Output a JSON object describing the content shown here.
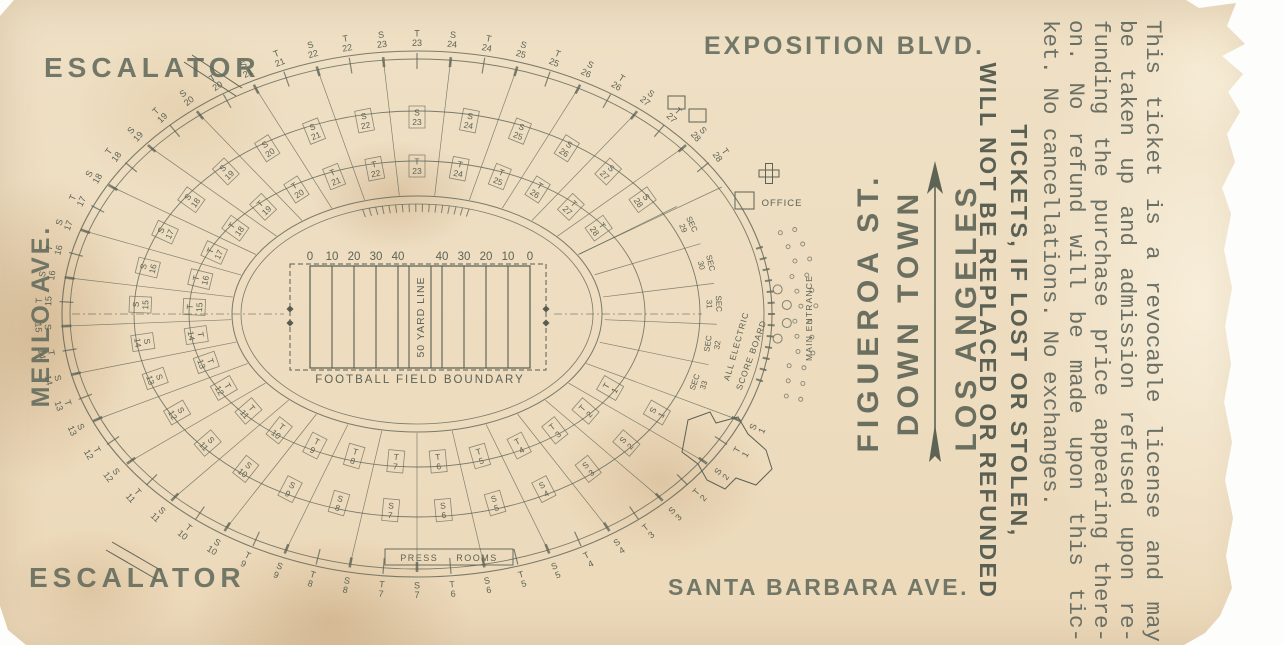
{
  "colors": {
    "ink": "#5c6255",
    "paper": "#efe0c5"
  },
  "streets": {
    "exposition": "EXPOSITION BLVD.",
    "santa_barbara": "SANTA BARBARA AVE.",
    "menlo": "MENLO AVE.",
    "escalator_top": "ESCALATOR",
    "escalator_bottom": "ESCALATOR"
  },
  "direction": {
    "street": "FIGUEROA ST.",
    "line2": "DOWN TOWN",
    "city": "LOS ANGELES"
  },
  "legal": {
    "lines": [
      "This ticket is a revocable license and may",
      "be taken up and admission refused upon re-",
      "funding the purchase price appearing there-",
      "on.  No refund will be made upon this tic-",
      "ket.  No cancellations.  No exchanges."
    ],
    "notice_line1": "TICKETS, IF LOST OR STOLEN,",
    "notice_line2": "WILL NOT BE REPLACED OR REFUNDED"
  },
  "field": {
    "yard_numbers": [
      "0",
      "10",
      "20",
      "30",
      "40",
      "40",
      "30",
      "20",
      "10",
      "0"
    ],
    "fifty_label": "50 YARD LINE",
    "boundary_label": "FOOTBALL FIELD BOUNDARY"
  },
  "stadium": {
    "section_prefix": "S",
    "tunnel_prefix": "T",
    "numbered_sections": 28,
    "inner_section_word": "SEC",
    "inner_sections": [
      "29",
      "30",
      "31",
      "32",
      "33"
    ],
    "labels": {
      "office": "OFFICE",
      "main_entrance": "MAIN ENTRANCE",
      "scoreboard_line1": "ALL ELECTRIC",
      "scoreboard_line2": "SCORE BOARD",
      "press_rooms": "PRESS ROOMS"
    }
  }
}
